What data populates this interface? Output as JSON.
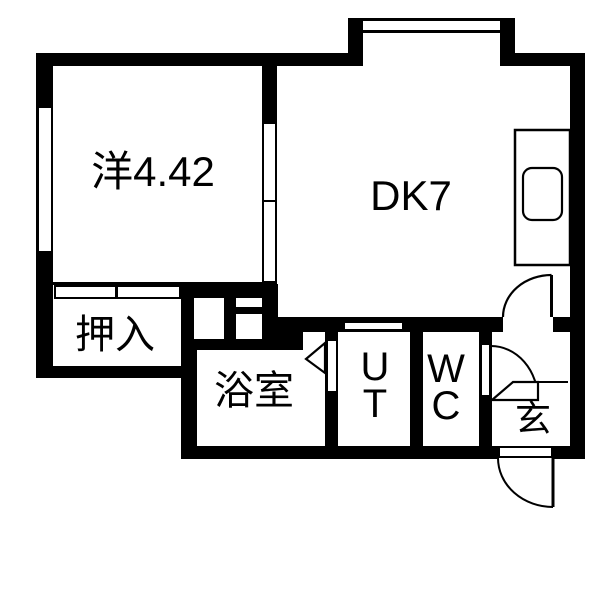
{
  "plan": {
    "floor_color": "#ffffff",
    "wall_color": "#000000"
  },
  "rooms": {
    "western": {
      "label": "洋4.42"
    },
    "dk": {
      "label": "DK7"
    },
    "closet": {
      "label": "押入"
    },
    "bath": {
      "label": "浴室"
    },
    "utility": {
      "line1": "U",
      "line2": "T"
    },
    "toilet": {
      "line1": "W",
      "line2": "C"
    },
    "entrance": {
      "label": "玄"
    }
  }
}
